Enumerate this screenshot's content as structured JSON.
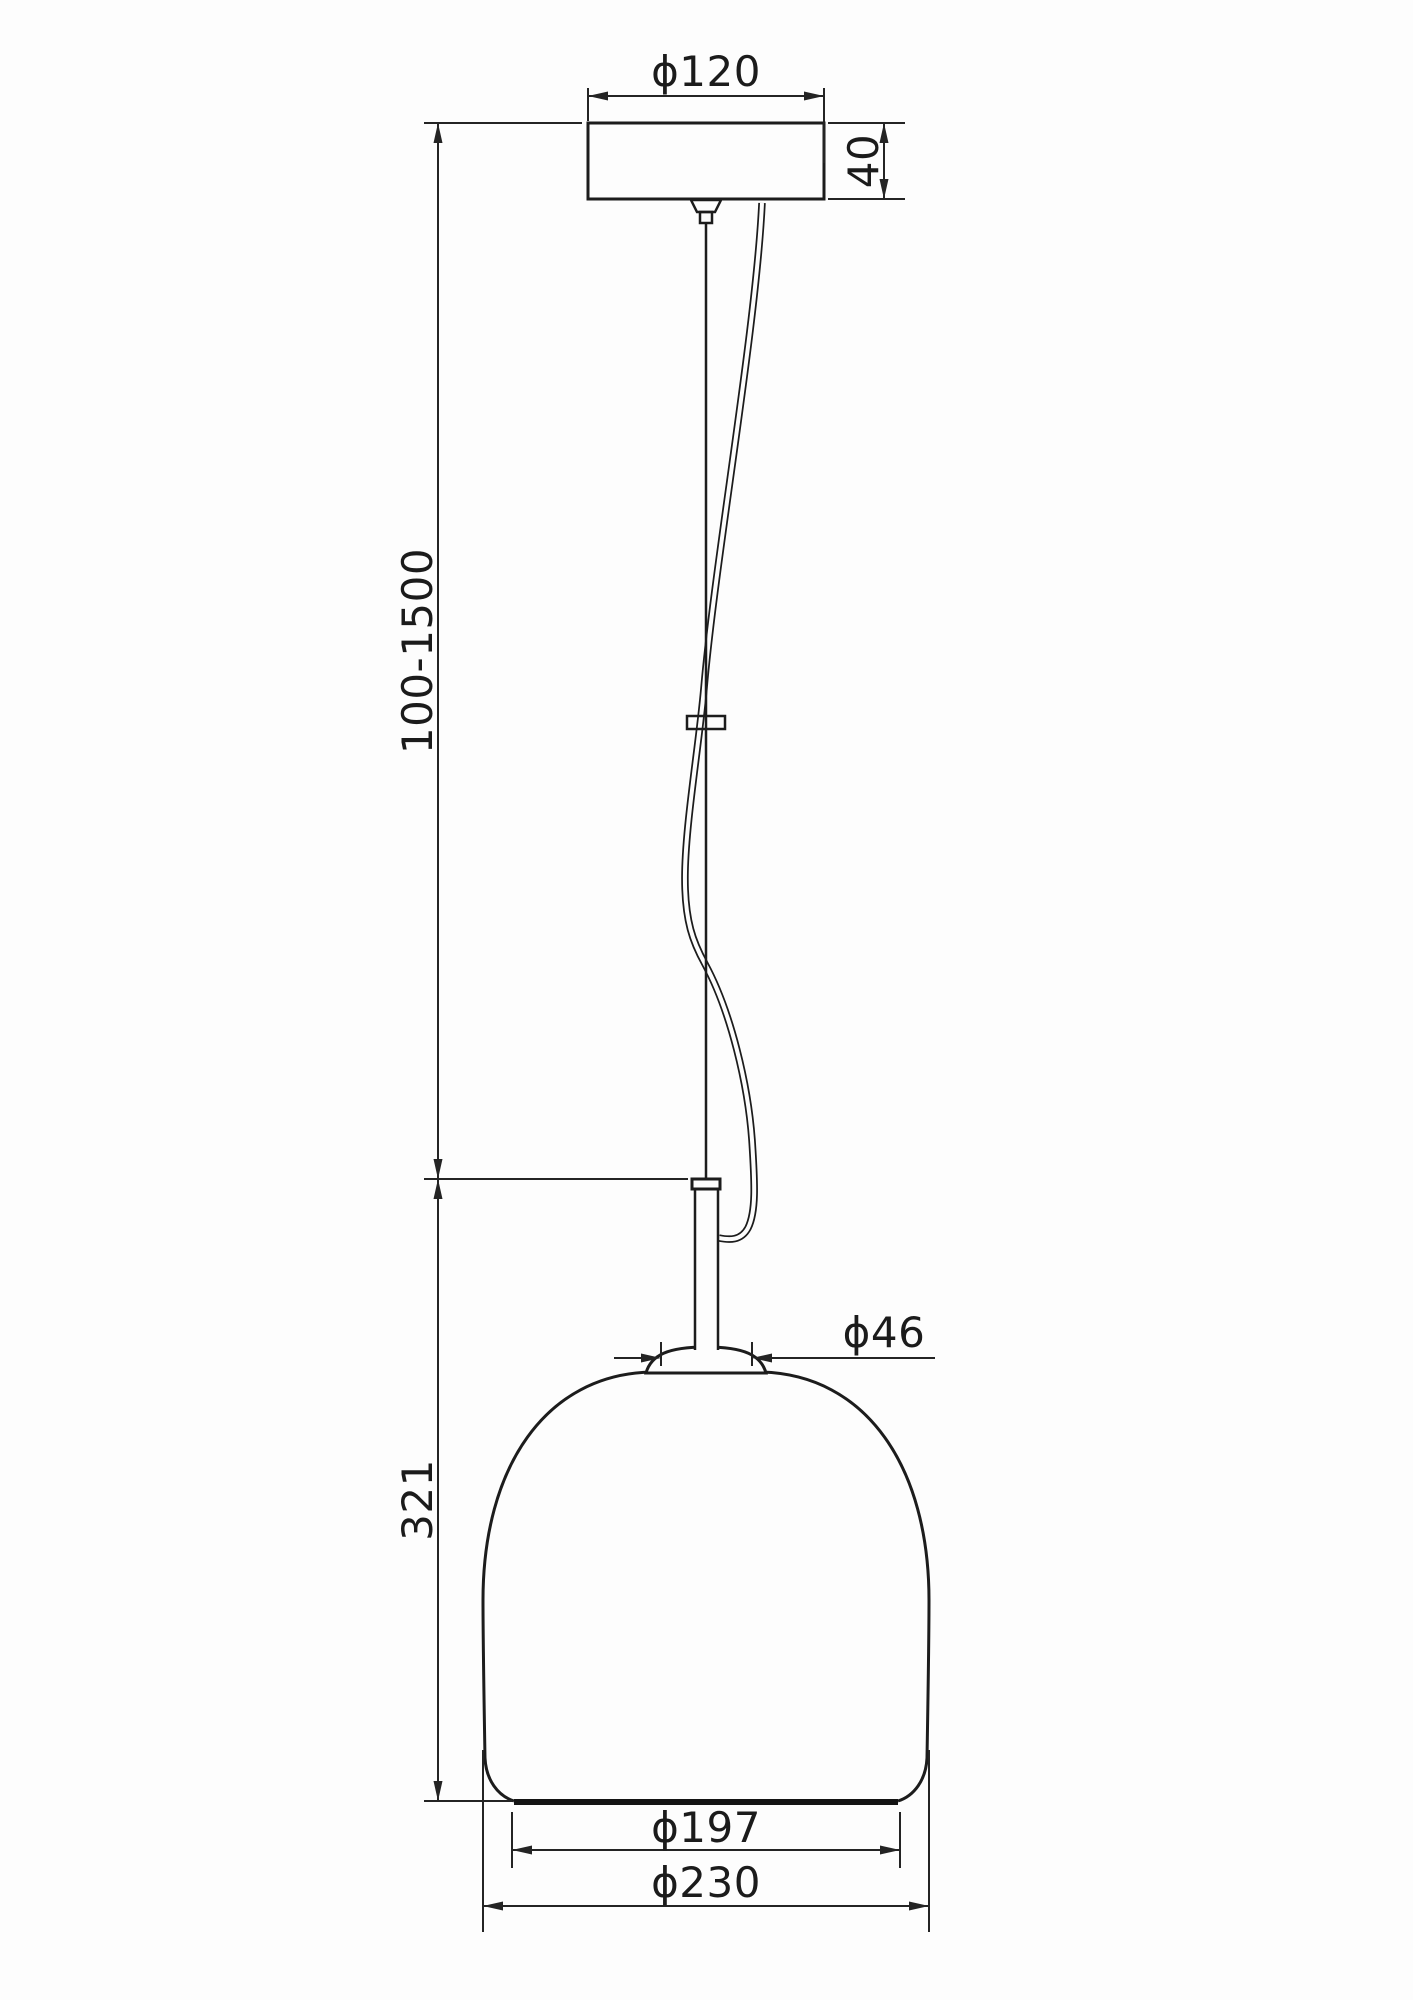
{
  "drawing": {
    "type": "technical-dimension-drawing",
    "subject": "pendant lamp line drawing",
    "background_color": "#fdfdfd",
    "line_color": "#1c1c1c",
    "labels": {
      "canopy_diameter": "ϕ120",
      "canopy_height": "40",
      "suspension_length_range": "100-1500",
      "shade_height": "321",
      "neck_diameter": "ϕ46",
      "shade_opening_diameter": "ϕ197",
      "shade_outer_diameter": "ϕ230"
    }
  }
}
